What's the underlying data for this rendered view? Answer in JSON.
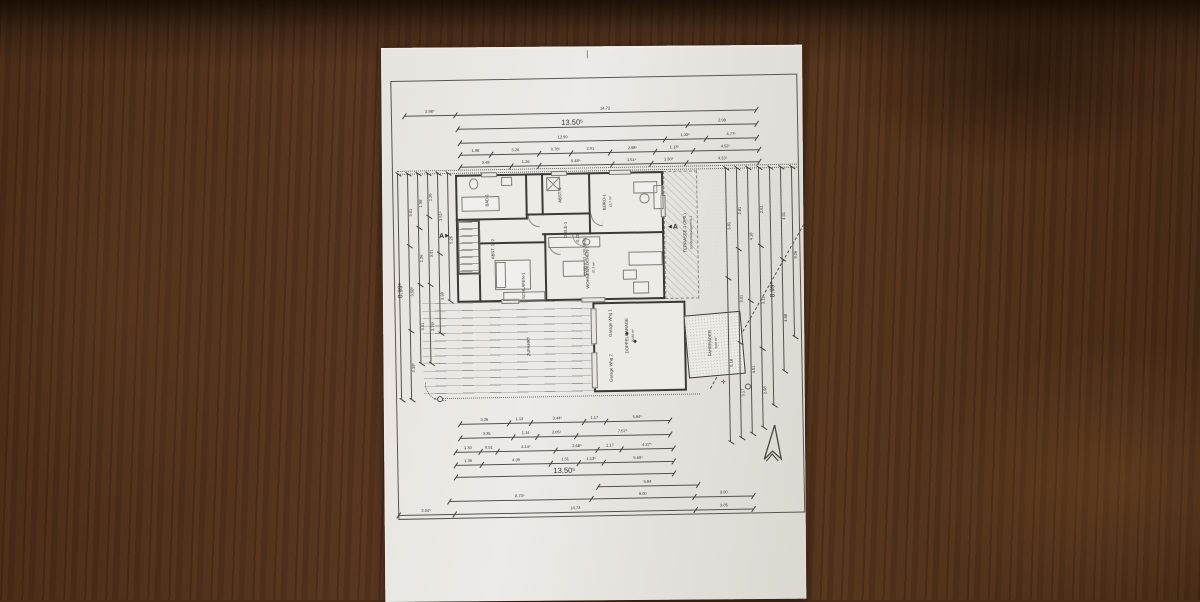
{
  "scene": {
    "colors": {
      "paper": "#e7e4df",
      "wood": "#54331c",
      "ink": "#3a3733"
    }
  },
  "plan": {
    "room_labels": [
      {
        "text": "BAD-1",
        "x": 106,
        "y": 152
      },
      {
        "text": "ABST.-1",
        "x": 179,
        "y": 148
      },
      {
        "text": "DIELE-1",
        "x": 184,
        "y": 183
      },
      {
        "text": "BÜRO-1",
        "sub": "12,7 m²",
        "x": 226,
        "y": 156
      },
      {
        "text": "WOHNEN/KOCHEN-1",
        "sub": "37,4 m²",
        "x": 208,
        "y": 221
      },
      {
        "text": "SCHLAFEN-1",
        "x": 141,
        "y": 238
      },
      {
        "text": "ABST. 1+2",
        "x": 111,
        "y": 201
      },
      {
        "text": "TERRASSE-1 (2Pfl.)",
        "sub": "Sondernutzungsrecht 1",
        "x": 306,
        "y": 188
      },
      {
        "text": "ZUFAHRT",
        "x": 145,
        "y": 299
      },
      {
        "text": "Garage Whg 1",
        "x": 227,
        "y": 277
      },
      {
        "text": "DOPPELGARAGE",
        "sub": "32,86 m²",
        "x": 246,
        "y": 290
      },
      {
        "text": "Garage Whg 2",
        "x": 227,
        "y": 322
      },
      {
        "text": "FAHRRÄDER",
        "sub": "8,00 m²",
        "x": 329,
        "y": 299
      }
    ],
    "level_labels": [
      {
        "text": "-0,20",
        "x": 196,
        "y": 192
      },
      {
        "text": "+0,00 = 37,425 NHN",
        "x": 203,
        "y": 211
      }
    ],
    "section_markers": [
      {
        "label": "A",
        "dir": "right",
        "x": 56,
        "y": 184
      },
      {
        "label": "A",
        "dir": "left",
        "x": 286,
        "y": 179
      }
    ],
    "north_arrow": "north-arrow"
  },
  "dimensions": {
    "top": [
      {
        "x": 24,
        "y": 57,
        "w": 352,
        "segs": [
          {
            "w": 12,
            "t": "2.98⁵"
          },
          {
            "w": 88,
            "t": "14.72"
          }
        ]
      },
      {
        "x": 77,
        "y": 71,
        "w": 299,
        "segs": [
          {
            "w": 78,
            "t": "13.50⁵",
            "big": true
          },
          {
            "w": 22,
            "t": "2.98"
          }
        ]
      },
      {
        "x": 79,
        "y": 85,
        "w": 297,
        "segs": [
          {
            "w": 74,
            "t": "12.99"
          },
          {
            "w": 11,
            "t": "1.32⁵"
          },
          {
            "w": 15,
            "t": "4.77⁵"
          }
        ]
      },
      {
        "x": 79,
        "y": 97,
        "w": 299,
        "segs": [
          {
            "w": 10,
            "t": "1.98"
          },
          {
            "w": 17,
            "t": "3.26"
          },
          {
            "w": 9,
            "t": "0.76⁵"
          },
          {
            "w": 13,
            "t": "2.01"
          },
          {
            "w": 15,
            "t": "2.98⁵"
          },
          {
            "w": 12,
            "t": "1.13⁵"
          },
          {
            "w": 24,
            "t": "4.52⁵"
          }
        ]
      },
      {
        "x": 79,
        "y": 109,
        "w": 299,
        "segs": [
          {
            "w": 18,
            "t": "3.48"
          },
          {
            "w": 8,
            "t": "1.26"
          },
          {
            "w": 26,
            "t": "5.48⁵"
          },
          {
            "w": 12,
            "t": "1.51⁵"
          },
          {
            "w": 10,
            "t": "1.30⁵"
          },
          {
            "w": 26,
            "t": "4.23⁵"
          }
        ]
      }
    ],
    "bottom": [
      {
        "x": 74,
        "y": 366,
        "w": 210,
        "segs": [
          {
            "w": 25,
            "t": "3.26"
          },
          {
            "w": 8,
            "t": "1.13"
          },
          {
            "w": 26,
            "t": "3.44⁵"
          },
          {
            "w": 8,
            "t": "1.17"
          },
          {
            "w": 33,
            "t": "5.84⁵"
          }
        ]
      },
      {
        "x": 74,
        "y": 380,
        "w": 210,
        "segs": [
          {
            "w": 26,
            "t": "3.35"
          },
          {
            "w": 9,
            "t": "1.14"
          },
          {
            "w": 16,
            "t": "2.05⁵"
          },
          {
            "w": 49,
            "t": "7.57⁵"
          }
        ]
      },
      {
        "x": 69,
        "y": 394,
        "w": 218,
        "segs": [
          {
            "w": 10,
            "t": "1.30"
          },
          {
            "w": 5,
            "t": "0.51"
          },
          {
            "w": 30,
            "t": "4.14⁵"
          },
          {
            "w": 20,
            "t": "2.68⁵"
          },
          {
            "w": 9,
            "t": "1.17"
          },
          {
            "w": 26,
            "t": "4.27⁵"
          }
        ]
      },
      {
        "x": 69,
        "y": 407,
        "w": 218,
        "segs": [
          {
            "w": 10,
            "t": "1.39"
          },
          {
            "w": 36,
            "t": "4.99"
          },
          {
            "w": 11,
            "t": "1.51"
          },
          {
            "w": 8,
            "t": "1.13⁵"
          },
          {
            "w": 35,
            "t": "5.60⁵"
          }
        ]
      },
      {
        "x": 69,
        "y": 419,
        "w": 218,
        "segs": [
          {
            "w": 100,
            "t": "13.50⁵",
            "big": true
          }
        ]
      },
      {
        "x": 211,
        "y": 431,
        "w": 100,
        "segs": [
          {
            "w": 100,
            "t": "5.84"
          }
        ]
      },
      {
        "x": 62,
        "y": 443,
        "w": 304,
        "segs": [
          {
            "w": 48,
            "t": "8.73⁵"
          },
          {
            "w": 34,
            "t": "9.00"
          },
          {
            "w": 18,
            "t": "3.00"
          }
        ]
      },
      {
        "x": 11,
        "y": 456,
        "w": 355,
        "segs": [
          {
            "w": 14,
            "t": "3.04⁵"
          },
          {
            "w": 71,
            "t": "14.73"
          },
          {
            "w": 15,
            "t": "3.05"
          }
        ]
      }
    ],
    "left": [
      {
        "x": 16,
        "y": 124,
        "h": 226,
        "segs": [
          {
            "w": 100,
            "t": "8.99⁵",
            "big": true
          }
        ]
      },
      {
        "x": 26,
        "y": 124,
        "h": 226,
        "segs": [
          {
            "w": 32,
            "t": "3.01"
          },
          {
            "w": 38,
            "t": "3.58⁵"
          },
          {
            "w": 30,
            "t": "2.39⁵"
          }
        ]
      },
      {
        "x": 36,
        "y": 124,
        "h": 190,
        "segs": [
          {
            "w": 28,
            "t": "1.98"
          },
          {
            "w": 30,
            "t": "2.26"
          },
          {
            "w": 42,
            "t": "3.51"
          }
        ]
      },
      {
        "x": 46,
        "y": 124,
        "h": 190,
        "segs": [
          {
            "w": 22,
            "t": "1.26"
          },
          {
            "w": 36,
            "t": "3.01"
          },
          {
            "w": 42,
            "t": "3.76⁵"
          }
        ]
      },
      {
        "x": 56,
        "y": 124,
        "h": 160,
        "segs": [
          {
            "w": 50,
            "t": "3.51⁵"
          },
          {
            "w": 50,
            "t": "3.38"
          }
        ]
      },
      {
        "x": 66,
        "y": 124,
        "h": 128,
        "segs": [
          {
            "w": 100,
            "t": "5.26"
          }
        ]
      }
    ],
    "right": [
      {
        "x": 344,
        "y": 124,
        "h": 274,
        "segs": [
          {
            "w": 40,
            "t": "3.81"
          },
          {
            "w": 60,
            "t": "5.18"
          }
        ]
      },
      {
        "x": 355,
        "y": 124,
        "h": 270,
        "segs": [
          {
            "w": 30,
            "t": "2.81"
          },
          {
            "w": 35,
            "t": "3.01"
          },
          {
            "w": 35,
            "t": "3.17"
          }
        ]
      },
      {
        "x": 366,
        "y": 124,
        "h": 266,
        "segs": [
          {
            "w": 50,
            "t": "4.18"
          },
          {
            "w": 50,
            "t": "4.51"
          }
        ]
      },
      {
        "x": 377,
        "y": 124,
        "h": 260,
        "segs": [
          {
            "w": 30,
            "t": "2.51"
          },
          {
            "w": 40,
            "t": "3.11"
          },
          {
            "w": 30,
            "t": "2.98"
          }
        ]
      },
      {
        "x": 388,
        "y": 124,
        "h": 238,
        "segs": [
          {
            "w": 100,
            "t": "8.99⁵",
            "big": true
          }
        ]
      },
      {
        "x": 399,
        "y": 124,
        "h": 204,
        "segs": [
          {
            "w": 45,
            "t": "4.01"
          },
          {
            "w": 55,
            "t": "4.98"
          }
        ]
      },
      {
        "x": 410,
        "y": 124,
        "h": 170,
        "segs": [
          {
            "w": 100,
            "t": "9.26"
          }
        ]
      }
    ]
  }
}
